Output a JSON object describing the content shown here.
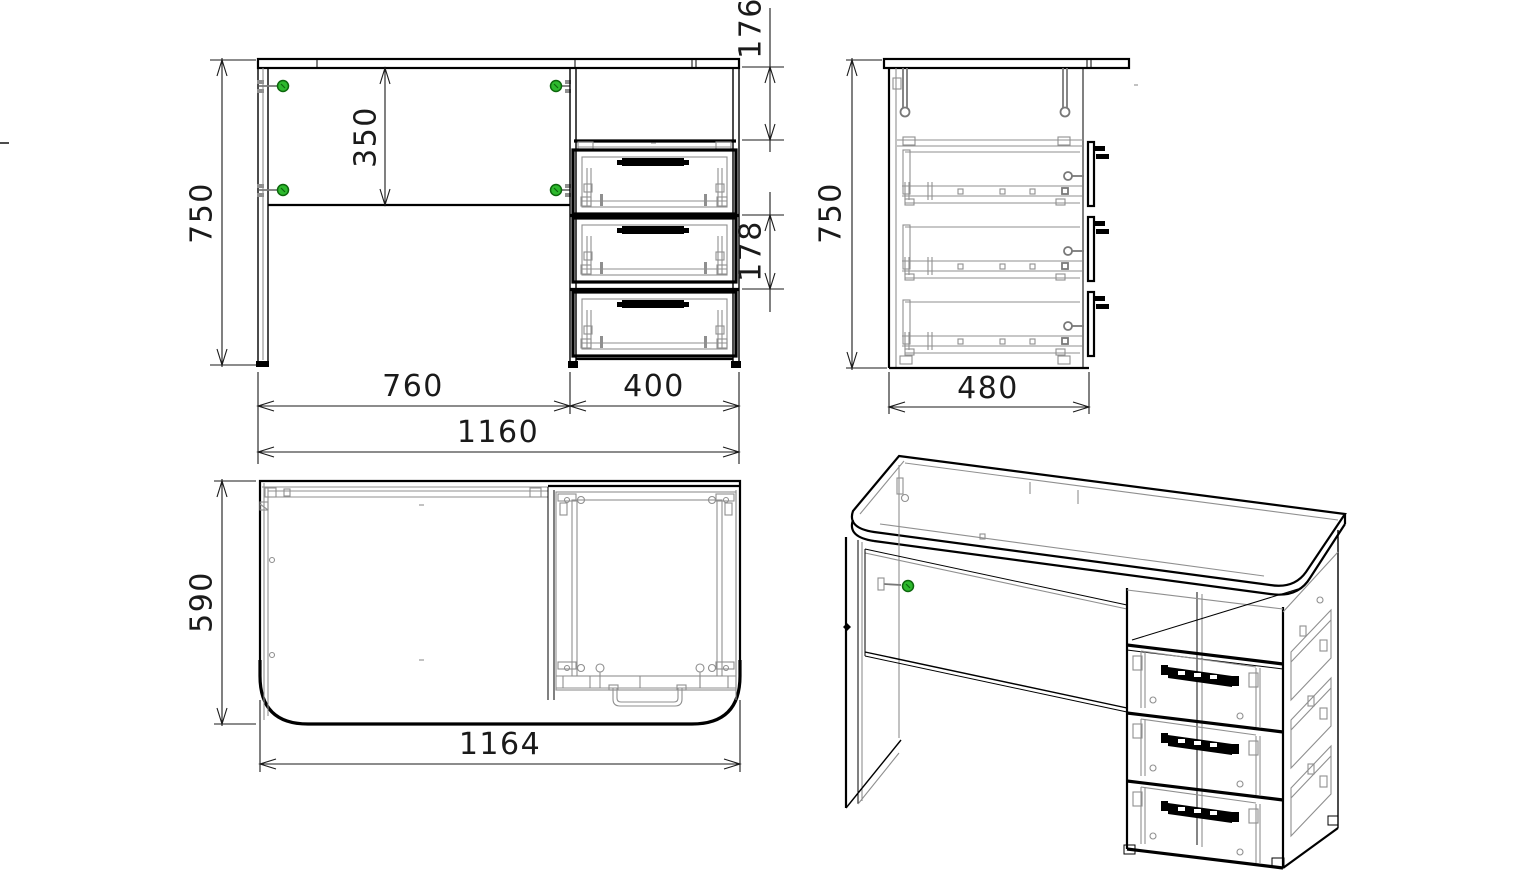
{
  "drawing": {
    "kind": "furniture assembly drawing",
    "subject": "desk with three-drawer pedestal",
    "colors": {
      "outline": "#000000",
      "detail_lines": "#8f8f8f",
      "screw_fill": "#2db92d",
      "screw_ring": "#0c660c",
      "dimension_text": "#1a1a1a",
      "background": "#ffffff"
    },
    "views": {
      "front": {
        "dims": {
          "overall_height": "750",
          "back_panel_drop": "350",
          "top_compartment_height": "176",
          "drawer_pitch": "178",
          "desk_section_width": "760",
          "pedestal_width": "400",
          "overall_width": "1160"
        }
      },
      "side": {
        "dims": {
          "overall_height": "750",
          "cabinet_depth": "480"
        }
      },
      "top": {
        "dims": {
          "top_depth": "590",
          "top_width": "1164"
        }
      }
    }
  }
}
